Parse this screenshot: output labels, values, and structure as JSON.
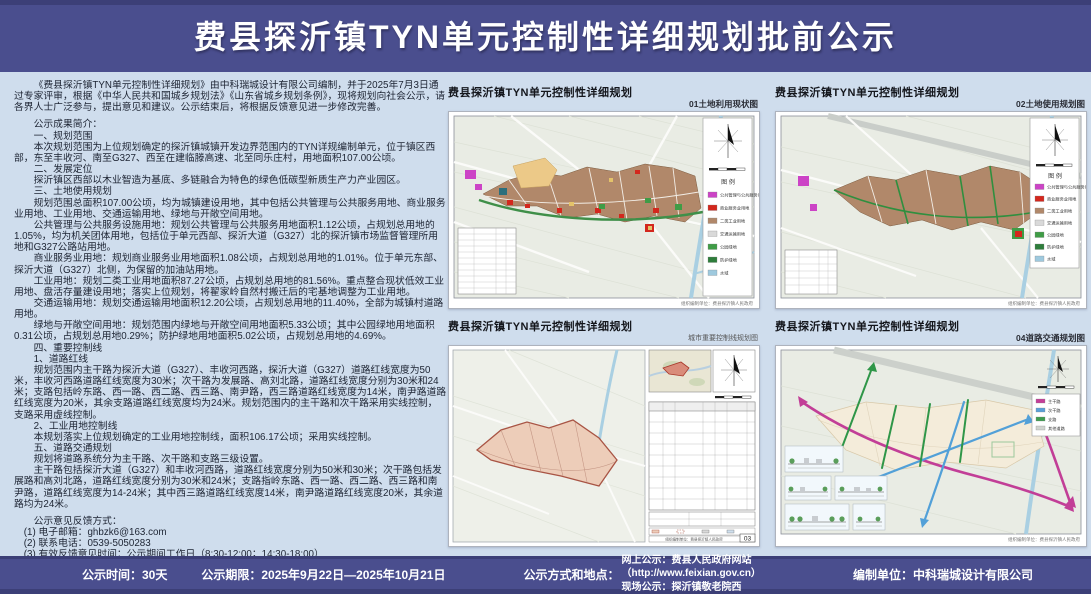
{
  "colors": {
    "banner": "#4a4e8e",
    "banner_edge": "#3c3f77",
    "page_bg": "#cfdded",
    "industry_brown": "#b1886a",
    "green_belt": "#3f8f49",
    "river_blue": "#a9cfe2"
  },
  "header": {
    "title": "费县探沂镇TYN单元控制性详细规划批前公示"
  },
  "notice": {
    "intro": "《费县探沂镇TYN单元控制性详细规划》由中科瑞城设计有限公司编制，并于2025年7月3日通过专家评审，根据《中华人民共和国城乡规划法》《山东省城乡规划条例》，现将规划向社会公示，请各界人士广泛参与，提出意见和建议。公示结束后，将根据反馈意见进一步修改完善。",
    "summary_heading": "公示成果简介：",
    "s1_heading": "一、规划范围",
    "s1_body": "本次规划范围为上位规划确定的探沂镇城镇开发边界范围内的TYN详规编制单元，位于镇区西部，东至丰收河、南至G327、西至在建临滕高速、北至同乐庄村，用地面积107.00公顷。",
    "s2_heading": "二、发展定位",
    "s2_body": "探沂镇区西部以木业智造为基底、多链融合为特色的绿色低碳型新质生产力产业园区。",
    "s3_heading": "三、土地使用规划",
    "s3_body1": "规划范围总面积107.00公顷，均为城镇建设用地，其中包括公共管理与公共服务用地、商业服务业用地、工业用地、交通运输用地、绿地与开敞空间用地。",
    "s3_body2": "公共管理与公共服务设施用地：规划公共管理与公共服务用地面积1.12公顷，占规划总用地的1.05%，均为机关团体用地，包括位于单元西部、探沂大道（G327）北的探沂镇市场监督管理所用地和G327公路站用地。",
    "s3_body3": "商业服务业用地：规划商业服务业用地面积1.08公顷，占规划总用地的1.01%。位于单元东部、探沂大道（G327）北侧，为保留的加油站用地。",
    "s3_body4": "工业用地：规划二类工业用地面积87.27公顷，占规划总用地的81.56%。重点整合现状低效工业用地、盘活存量建设用地；落实上位规划，将翟家岭自然村搬迁后的宅基地调整为工业用地。",
    "s3_body5": "交通运输用地：规划交通运输用地面积12.20公顷，占规划总用地的11.40%，全部为城镇村道路用地。",
    "s3_body6": "绿地与开敞空间用地：规划范围内绿地与开敞空间用地面积5.33公顷；其中公园绿地用地面积0.31公顷，占规划总用地0.29%；防护绿地用地面积5.02公顷，占规划总用地的4.69%。",
    "s4_heading": "四、重要控制线",
    "s4_sub1": "1、道路红线",
    "s4_body1": "规划范围内主干路为探沂大道（G327）、丰收河西路，探沂大道（G327）道路红线宽度为50米，丰收河西路道路红线宽度为30米；次干路为发展路、高刘北路，道路红线宽度分别为30米和24米；支路包括岭东路、西一路、西二路、西三路、南尹路，西三路道路红线宽度为14米，南尹路道路红线宽度为20米，其余支路道路红线宽度均为24米。规划范围内的主干路和次干路采用实线控制，支路采用虚线控制。",
    "s4_sub2": "2、工业用地控制线",
    "s4_body2": "本规划落实上位规划确定的工业用地控制线，面积106.17公顷；采用实线控制。",
    "s5_heading": "五、道路交通规划",
    "s5_body1": "规划将道路系统分为主干路、次干路和支路三级设置。",
    "s5_body2": "主干路包括探沂大道（G327）和丰收河西路，道路红线宽度分别为50米和30米；次干路包括发展路和高刘北路，道路红线宽度分别为30米和24米；支路指岭东路、西一路、西二路、西三路和南尹路，道路红线宽度为14-24米；其中西三路道路红线宽度14米，南尹路道路红线宽度20米，其余道路均为24米。",
    "feedback_heading": "公示意见反馈方式：",
    "feedback_1": "(1) 电子邮箱：ghbzk6@163.com",
    "feedback_2": "(2) 联系电话：0539-5050283",
    "feedback_3": "(3) 有效反馈意见时间：公示期间工作日（8:30-12:00；14:30-18:00）",
    "feedback_4": "(4) 有效反馈意见方式：请留下真实姓名、电话、联系方式，以便反馈意见采纳情况。"
  },
  "panels": {
    "p1": {
      "title": "费县探沂镇TYN单元控制性详细规划",
      "subtitle": "01土地利用现状图"
    },
    "p2": {
      "title": "费县探沂镇TYN单元控制性详细规划",
      "subtitle": "02土地使用规划图"
    },
    "p3": {
      "title": "费县探沂镇TYN单元控制性详细规划",
      "subtitle": "城市重要控制线规划图",
      "page_no": "03"
    },
    "p4": {
      "title": "费县探沂镇TYN单元控制性详细规划",
      "subtitle": "04道路交通规划图"
    },
    "legend_title": "图 例",
    "credit": "组织编制单位：费县探沂镇人民政府"
  },
  "legends": {
    "landuse": [
      {
        "label": "公共管理与公共服务用地",
        "color": "#cc43c6"
      },
      {
        "label": "商业服务业用地",
        "color": "#d3271d"
      },
      {
        "label": "二类工业用地",
        "color": "#b1886a"
      },
      {
        "label": "交通运输用地",
        "color": "#d9d9d9"
      },
      {
        "label": "公园绿地",
        "color": "#3f9c46"
      },
      {
        "label": "防护绿地",
        "color": "#2e7d3b"
      },
      {
        "label": "水域",
        "color": "#9ec9de"
      }
    ],
    "roads": [
      {
        "label": "主干路",
        "color": "#c43e98"
      },
      {
        "label": "次干路",
        "color": "#5aa0d8"
      },
      {
        "label": "支路",
        "color": "#3f9c50"
      },
      {
        "label": "其他道路",
        "color": "#d0d4cf"
      }
    ]
  },
  "footer": {
    "time": "公示时间：30天",
    "period": "公示期限：2025年9月22日—2025年10月21日",
    "method_label": "公示方式和地点：",
    "online": "网上公示：费县人民政府网站（http://www.feixian.gov.cn）",
    "onsite": "现场公示：探沂镇敬老院西",
    "unit": "编制单位：中科瑞城设计有限公司"
  }
}
